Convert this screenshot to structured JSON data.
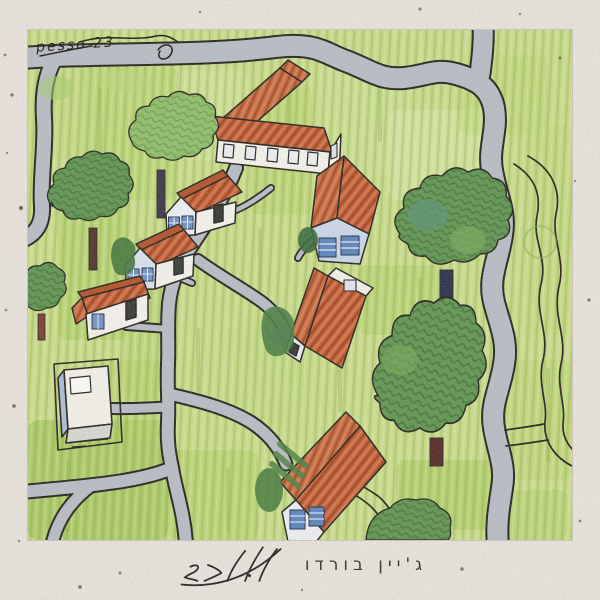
{
  "artwork": {
    "signature": "pesso 23",
    "band_name": "ג'יין בורדו",
    "handwritten_title": "ליל חג"
  },
  "colors": {
    "frame_paper": "#e9e3de",
    "grass": "#cbdd8d",
    "grass_dark": "#9dc253",
    "road_gray": "#b9bec6",
    "ink": "#2b2824",
    "roof_red": "#c8663c",
    "wall_white": "#f3f1ea",
    "window_blue": "#7395c5",
    "tree_dark": "#649755",
    "tree_light": "#93bf6d"
  }
}
